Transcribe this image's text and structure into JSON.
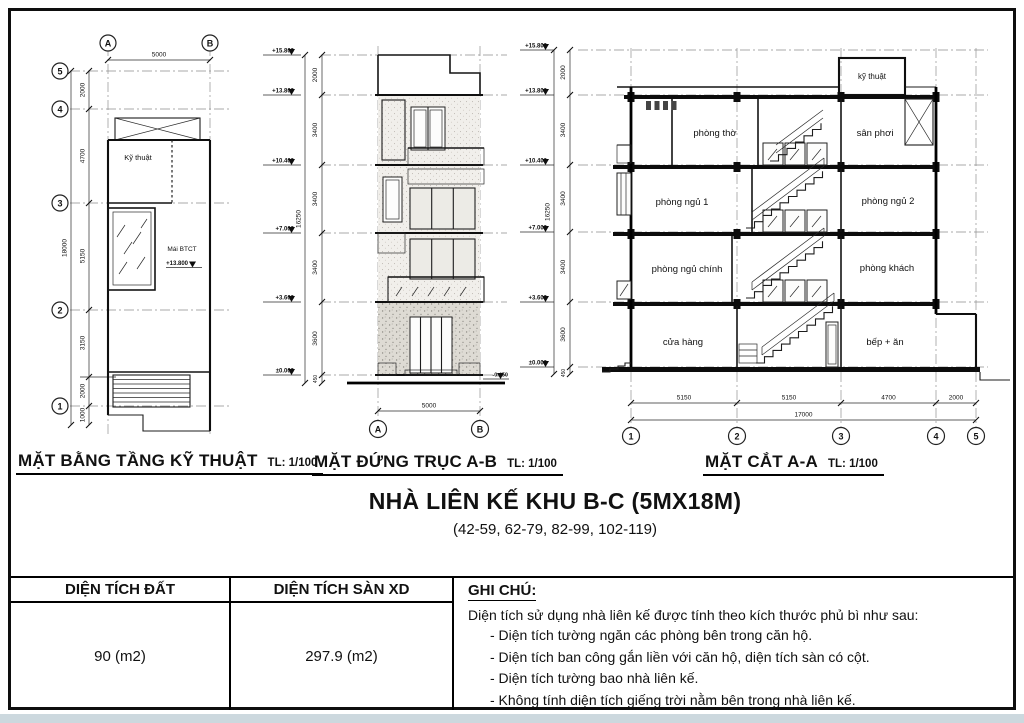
{
  "plan": {
    "title": "MẶT BẰNG TẦNG KỸ THUẬT",
    "scale": "TL: 1/100",
    "col_bubbles": [
      "A",
      "B"
    ],
    "row_bubbles": [
      "5",
      "4",
      "3",
      "2",
      "1"
    ],
    "width_dim": "5000",
    "row_dims": [
      "2000",
      "4700",
      "5150",
      "3150",
      "2000",
      "1000"
    ],
    "total_dim": "18000",
    "room_label": "Kỹ thuật",
    "roof_note": "Mái BTCT",
    "roof_level": "+13.800"
  },
  "elevation": {
    "title": "MẶT ĐỨNG TRỤC A-B",
    "scale": "TL: 1/100",
    "levels": [
      "+15.800",
      "+13.800",
      "+10.400",
      "+7.000",
      "+3.600",
      "±0.000"
    ],
    "level_dims": [
      "2000",
      "3400",
      "3400",
      "3400",
      "3600",
      "450"
    ],
    "total_dim": "16250",
    "width_dim": "5000",
    "col_bubbles": [
      "A",
      "B"
    ],
    "right_level": "-0.450"
  },
  "section": {
    "title": "MẶT CẮT A-A",
    "scale": "TL: 1/100",
    "levels": [
      "+15.800",
      "+13.800",
      "+10.400",
      "+7.000",
      "+3.600",
      "±0.000"
    ],
    "level_dims": [
      "2000",
      "3400",
      "3400",
      "3400",
      "3600",
      "450"
    ],
    "total_dim": "16250",
    "rooms": [
      "phòng thờ",
      "sân phơi",
      "kỹ thuật",
      "phòng ngủ 1",
      "phòng ngủ 2",
      "phòng ngủ chính",
      "phòng khách",
      "cửa hàng",
      "bếp + ăn"
    ],
    "bottom_dims": [
      "5150",
      "5150",
      "4700",
      "2000"
    ],
    "total_width_dim": "17000",
    "grid_bubbles": [
      "1",
      "2",
      "3",
      "4",
      "5"
    ]
  },
  "title_block": {
    "main_title": "NHÀ LIÊN KẾ KHU B-C (5MX18M)",
    "subtitle": "(42-59, 62-79, 82-99, 102-119)"
  },
  "table": {
    "col1_header": "DIỆN TÍCH ĐẤT",
    "col2_header": "DIỆN TÍCH SÀN XD",
    "col1_value": "90 (m2)",
    "col2_value": "297.9 (m2)",
    "notes_header": "GHI CHÚ:",
    "notes_intro": "Diện tích sử dụng nhà liên kế được tính theo kích thước phủ bì như sau:",
    "notes": [
      "- Diện tích tường ngăn các phòng bên trong căn hộ.",
      "- Diện tích ban công gắn liền với căn hộ, diện tích sàn có cột.",
      "- Diện tích tường bao nhà liên kế.",
      "- Không tính diện tích giếng trời nằm bên trong nhà liên kế."
    ]
  }
}
